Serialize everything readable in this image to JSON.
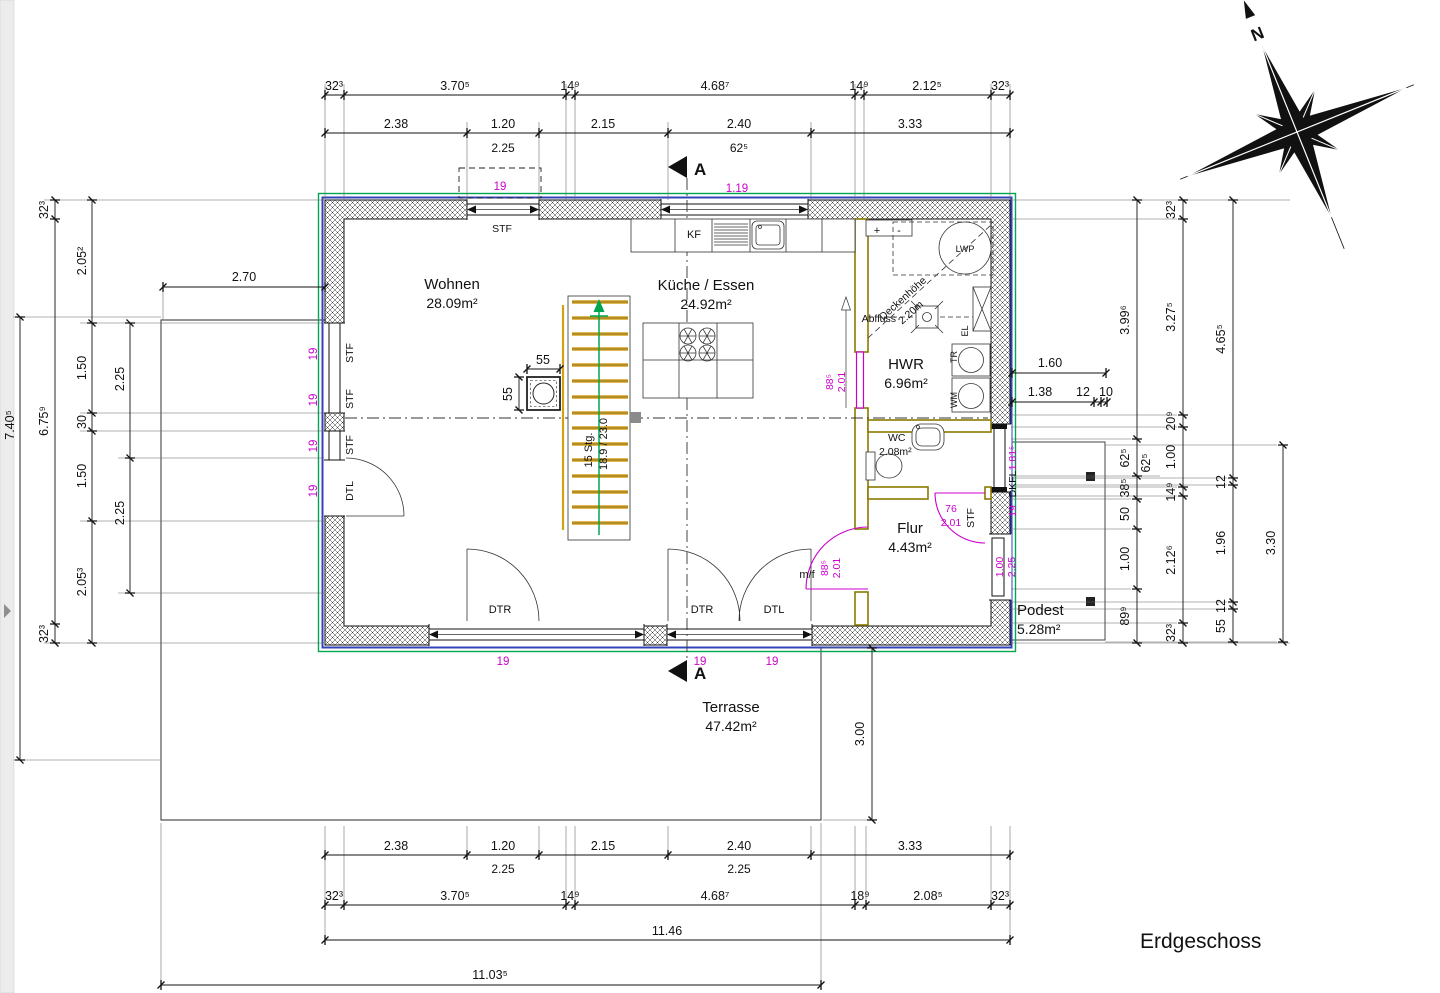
{
  "floor_label": "Erdgeschoss",
  "compass_north": "N",
  "section_marker": "A",
  "rooms": {
    "wohnen": {
      "name": "Wohnen",
      "area": "28.09m²"
    },
    "kueche": {
      "name": "Küche / Essen",
      "area": "24.92m²"
    },
    "hwr": {
      "name": "HWR",
      "area": "6.96m²"
    },
    "wc": {
      "name": "WC",
      "area": "2.08m²"
    },
    "flur": {
      "name": "Flur",
      "area": "4.43m²"
    },
    "podest": {
      "name": "Podest",
      "area": "5.28m²"
    },
    "terrasse": {
      "name": "Terrasse",
      "area": "47.42m²"
    }
  },
  "stairs": {
    "label1": "15 Stg.",
    "label2": "18.9 / 23.0"
  },
  "fixtures": {
    "kf": "KF",
    "lwp": "LWP",
    "abfluss": "Abfluss",
    "el": "EL",
    "tr": "TR",
    "wm": "WM",
    "plus": "+",
    "minus": "-",
    "ceiling1": "Deckenhöhe",
    "ceiling2": "2.20m"
  },
  "doors": {
    "dtr1": "DTR",
    "dtr2": "DTR",
    "dtl1": "DTL",
    "dtl2": "DTL",
    "mf": "m/f",
    "dkfl": "DKFL"
  },
  "window_labels": {
    "stf_top": "STF",
    "stf_l1": "STF",
    "stf_l2": "STF",
    "stf_l3": "STF",
    "stf_flur": "STF"
  },
  "dims": {
    "top1": [
      "32³",
      "3.70⁵",
      "14⁹",
      "4.68⁷",
      "14⁹",
      "2.12⁵",
      "32³"
    ],
    "top2": [
      "2.38",
      "1.20",
      "2.15",
      "2.40",
      "3.33"
    ],
    "top2_sub": [
      "2.25",
      "62⁵"
    ],
    "bottom1": [
      "2.38",
      "1.20",
      "2.15",
      "2.40",
      "3.33"
    ],
    "bottom1_sub": [
      "2.25",
      "2.25"
    ],
    "bottom2": [
      "32³",
      "3.70⁵",
      "14⁹",
      "4.68⁷",
      "18⁹",
      "2.08⁵",
      "32³"
    ],
    "bottom_total": "11.46",
    "bottom_overall": "11.03⁵",
    "left_overall": "7.40⁵",
    "left_outer": [
      "32³",
      "6.75⁹",
      "32³"
    ],
    "left_inner": [
      "2.05²",
      "1.50",
      "30",
      "1.50",
      "2.05³"
    ],
    "left_windows": [
      "2.25",
      "2.25"
    ],
    "right_inner": [
      "3.99⁶",
      "62⁵",
      "38⁵",
      "50",
      "1.00",
      "89⁹"
    ],
    "right_extra": "62⁵",
    "right_mid": [
      "32³",
      "3.27⁵",
      "20⁹",
      "1.00",
      "14⁹",
      "2.12⁶",
      "32³"
    ],
    "right_outer": [
      "4.65⁵",
      "12",
      "1.96",
      "12",
      "55"
    ],
    "right_podest": "3.30",
    "terrace_width": "2.70",
    "terrace_depth": "3.00",
    "hwr_dim1": "1.60",
    "hwr_dim2": [
      "1.38",
      "12",
      "10"
    ],
    "chimney": [
      "55",
      "55"
    ]
  },
  "magenta": {
    "win_top": "19",
    "win_top2": "1.19",
    "left": [
      "19",
      "19",
      "19",
      "19"
    ],
    "bottom": [
      "19",
      "19",
      "19"
    ],
    "kitchen_door": [
      "88⁵",
      "2.01"
    ],
    "mf_door": [
      "88⁵",
      "2.01"
    ],
    "flur_door": [
      "76",
      "2.01"
    ],
    "right_window": [
      "1.81⁵",
      "19"
    ],
    "podest_door": [
      "1.00",
      "2.25"
    ]
  },
  "colors": {
    "magenta": "#cc00cc",
    "green": "#00a651",
    "blue": "#3344bb",
    "olive": "#8a7a00",
    "stair": "#d4a017"
  }
}
